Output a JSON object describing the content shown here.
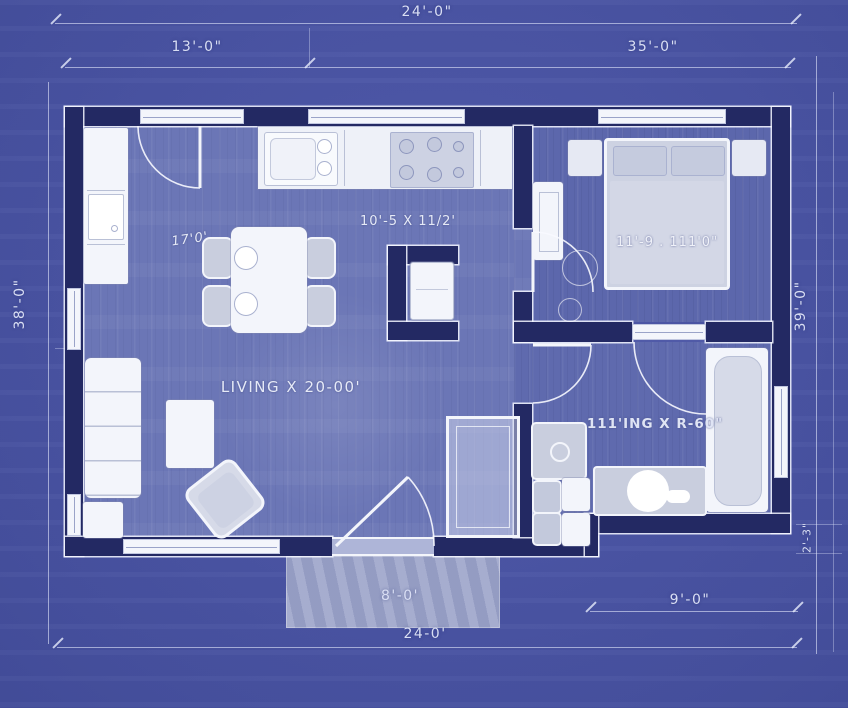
{
  "dims": {
    "top_total": "24'-0\"",
    "top_left": "13'-0\"",
    "top_right": "35'-0\"",
    "left": "38'-0\"",
    "right": "39'-0\"",
    "step_right": "2'-3\"",
    "porch": "8'-0'",
    "bottom_right": "9'-0\"",
    "bottom_total": "24-0'"
  },
  "labels": {
    "kitchen": "10'-5 X 11/2'",
    "dining": "17'0'",
    "living": "LIVING X 20-00'",
    "bedroom": "11'-9 . 111'0\"",
    "bathroom": "111'ING X R-60\""
  },
  "colors": {
    "background": "#4a54a3",
    "wall": "#232963",
    "floor_living": "#6b76b6",
    "floor_bedroom": "#5c67ac",
    "floor_bathroom": "#5f6aae",
    "fixture_white": "#f3f5fb",
    "fixture_gray": "#c9cede",
    "porch": "#9aa2c8",
    "dimension_text": "#d9def3"
  }
}
